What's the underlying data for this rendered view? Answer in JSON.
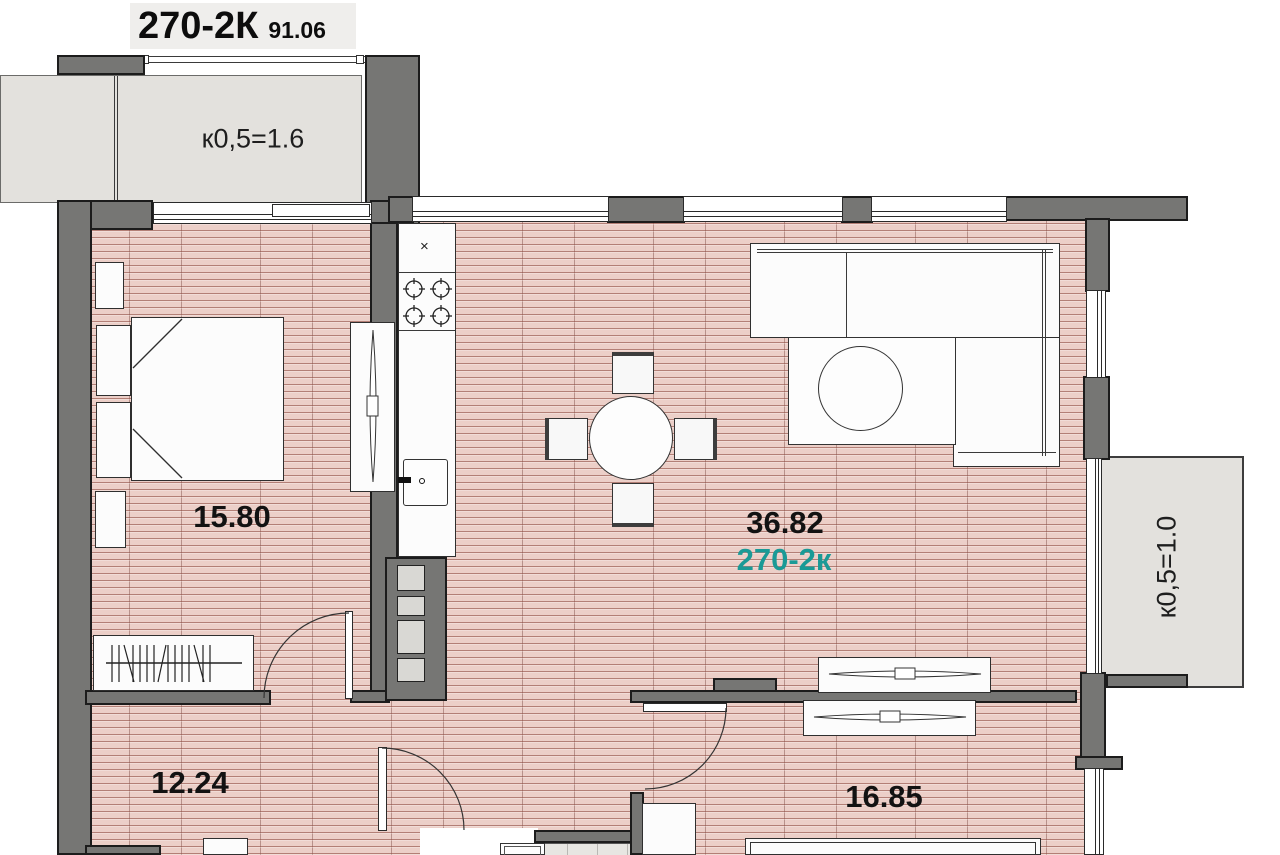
{
  "title": {
    "code": "270-2К",
    "area": "91.06"
  },
  "labels": {
    "bedroom_area": "15.80",
    "living_area": "36.82",
    "living_unit": "270-2к",
    "hall_area": "12.24",
    "bedroom2_area": "16.85",
    "balcony_top": "к0,5=1.6",
    "balcony_right": "к0,5=1.0",
    "fridge_mark": "×"
  },
  "colors": {
    "wall": "#767674",
    "floor": "#eccfc8",
    "balcony_floor": "#e3e1dd",
    "accent_teal": "#1a9a96"
  }
}
